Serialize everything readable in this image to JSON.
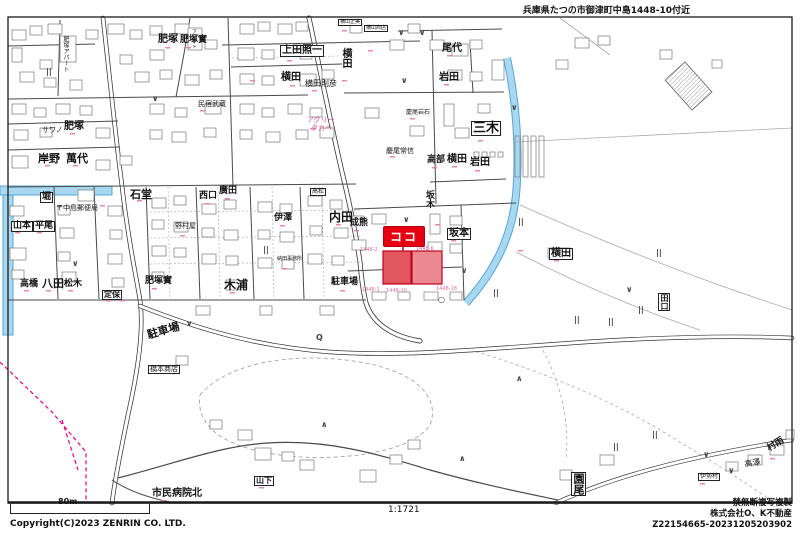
{
  "title": "兵庫県たつの市御津町中島1448-10付近",
  "footer": {
    "scale_bar_label": "80m",
    "copyright": "Copyright(C)2023 ZENRIN CO. LTD.",
    "scale_ratio": "1:1721",
    "notice": "禁無断複写複製",
    "company": "株式会社O、K不動産",
    "serial": "Z22154665-20231205203902"
  },
  "marker": {
    "label": "ココ",
    "color": "#e60012"
  },
  "colors": {
    "water_fill": "#a8d8f0",
    "water_stroke": "#58a6d6",
    "boundary_pink": "#e6007e",
    "parcel_pink": "#e06aa8",
    "highlight_fill": "#e2565e",
    "highlight_stroke": "#c00020",
    "road": "#4a4a4a"
  },
  "map": {
    "labels": [
      {
        "t": "肥塚",
        "x": 158,
        "y": 35,
        "c": "b10"
      },
      {
        "t": "肥塚實",
        "x": 180,
        "y": 36,
        "c": "b9"
      },
      {
        "t": "肥塚アパート",
        "x": 62,
        "y": 36,
        "c": "v sm6"
      },
      {
        "t": "アパート",
        "x": 191,
        "y": 29,
        "c": "v sm5"
      },
      {
        "t": "肥塚",
        "x": 64,
        "y": 122,
        "c": "b10"
      },
      {
        "t": "サワノ",
        "x": 42,
        "y": 127,
        "c": "sm7"
      },
      {
        "t": "岸野",
        "x": 38,
        "y": 153,
        "c": "b11"
      },
      {
        "t": "萬代",
        "x": 66,
        "y": 153,
        "c": "b11"
      },
      {
        "t": "堀",
        "x": 40,
        "y": 192,
        "c": "b9 box"
      },
      {
        "t": "〒中島郵便局",
        "x": 56,
        "y": 205,
        "c": "sm7"
      },
      {
        "t": "山本",
        "x": 11,
        "y": 221,
        "c": "b9 box"
      },
      {
        "t": "平尾",
        "x": 33,
        "y": 221,
        "c": "b9 box"
      },
      {
        "t": "八田",
        "x": 42,
        "y": 278,
        "c": "b11"
      },
      {
        "t": "高橋",
        "x": 20,
        "y": 280,
        "c": "b9"
      },
      {
        "t": "松木",
        "x": 64,
        "y": 280,
        "c": "b9"
      },
      {
        "t": "定保",
        "x": 102,
        "y": 290,
        "c": "b8 box"
      },
      {
        "t": "石堂",
        "x": 130,
        "y": 189,
        "c": "b11"
      },
      {
        "t": "肥塚實",
        "x": 145,
        "y": 277,
        "c": "b9"
      },
      {
        "t": "西口",
        "x": 199,
        "y": 192,
        "c": "b9"
      },
      {
        "t": "廣田",
        "x": 219,
        "y": 187,
        "c": "b9"
      },
      {
        "t": "伊澤",
        "x": 274,
        "y": 214,
        "c": "b9"
      },
      {
        "t": "内田",
        "x": 329,
        "y": 211,
        "c": "b12"
      },
      {
        "t": "木浦",
        "x": 224,
        "y": 279,
        "c": "b12"
      },
      {
        "t": "駐車場",
        "x": 146,
        "y": 330,
        "c": "b11",
        "r": -16
      },
      {
        "t": "駐車場",
        "x": 331,
        "y": 278,
        "c": "b9"
      },
      {
        "t": "橋本商店",
        "x": 148,
        "y": 365,
        "c": "sm7 box"
      },
      {
        "t": "市民病院北",
        "x": 152,
        "y": 489,
        "c": "b10"
      },
      {
        "t": "山下",
        "x": 254,
        "y": 476,
        "c": "b8 box"
      },
      {
        "t": "上田照一",
        "x": 280,
        "y": 45,
        "c": "b10 box"
      },
      {
        "t": "横田",
        "x": 340,
        "y": 48,
        "c": "b10 v"
      },
      {
        "t": "横田",
        "x": 281,
        "y": 73,
        "c": "b10"
      },
      {
        "t": "横田則彦",
        "x": 305,
        "y": 80,
        "c": "sm8"
      },
      {
        "t": "アグリー",
        "x": 307,
        "y": 117,
        "c": "sm7 pk"
      },
      {
        "t": "タカベ",
        "x": 311,
        "y": 125,
        "c": "sm7 pk"
      },
      {
        "t": "尾代",
        "x": 442,
        "y": 44,
        "c": "b10"
      },
      {
        "t": "岩田",
        "x": 439,
        "y": 73,
        "c": "b10"
      },
      {
        "t": "三木",
        "x": 471,
        "y": 121,
        "c": "b13 box"
      },
      {
        "t": "高部",
        "x": 427,
        "y": 156,
        "c": "b9"
      },
      {
        "t": "横田",
        "x": 447,
        "y": 155,
        "c": "b10"
      },
      {
        "t": "岩田",
        "x": 470,
        "y": 158,
        "c": "b10"
      },
      {
        "t": "慶尾岩石",
        "x": 406,
        "y": 110,
        "c": "sm6"
      },
      {
        "t": "慶尾常信",
        "x": 386,
        "y": 148,
        "c": "sm7"
      },
      {
        "t": "民宿武蔵",
        "x": 198,
        "y": 101,
        "c": "sm7"
      },
      {
        "t": "成熊",
        "x": 350,
        "y": 219,
        "c": "b9"
      },
      {
        "t": "坂木",
        "x": 424,
        "y": 190,
        "c": "b9 v"
      },
      {
        "t": "坂本",
        "x": 447,
        "y": 228,
        "c": "b10 box"
      },
      {
        "t": "横田",
        "x": 549,
        "y": 248,
        "c": "b10 box"
      },
      {
        "t": "田口",
        "x": 658,
        "y": 293,
        "c": "b8 box v"
      },
      {
        "t": "園尾",
        "x": 571,
        "y": 472,
        "c": "b11 box v"
      },
      {
        "t": "村雨",
        "x": 766,
        "y": 446,
        "c": "b9",
        "r": -32
      },
      {
        "t": "高澤",
        "x": 744,
        "y": 461,
        "c": "sm8",
        "r": -10
      },
      {
        "t": "横山正美",
        "x": 338,
        "y": 19,
        "c": "sm5 box"
      },
      {
        "t": "横山商店",
        "x": 364,
        "y": 25,
        "c": "sm5 box"
      },
      {
        "t": "野村屋",
        "x": 175,
        "y": 223,
        "c": "sm7"
      },
      {
        "t": "納田事務所",
        "x": 277,
        "y": 257,
        "c": "sm5"
      },
      {
        "t": "高松",
        "x": 310,
        "y": 188,
        "c": "sm6 box"
      },
      {
        "t": "伊勢村",
        "x": 698,
        "y": 473,
        "c": "sm6 box"
      }
    ],
    "symbols": [
      {
        "g": "∨",
        "x": 152,
        "y": 95
      },
      {
        "g": "∨",
        "x": 398,
        "y": 29
      },
      {
        "g": "∨",
        "x": 419,
        "y": 29
      },
      {
        "g": "∨",
        "x": 401,
        "y": 77
      },
      {
        "g": "∨",
        "x": 511,
        "y": 104
      },
      {
        "g": "∨",
        "x": 403,
        "y": 216
      },
      {
        "g": "∨",
        "x": 461,
        "y": 267
      },
      {
        "g": "∨",
        "x": 186,
        "y": 320
      },
      {
        "g": "∨",
        "x": 72,
        "y": 260
      },
      {
        "g": "∨",
        "x": 703,
        "y": 451
      },
      {
        "g": "∨",
        "x": 728,
        "y": 467
      },
      {
        "g": "∨",
        "x": 626,
        "y": 286
      },
      {
        "g": "||",
        "x": 46,
        "y": 68
      },
      {
        "g": "||",
        "x": 263,
        "y": 246
      },
      {
        "g": "||",
        "x": 493,
        "y": 289
      },
      {
        "g": "||",
        "x": 518,
        "y": 218
      },
      {
        "g": "||",
        "x": 656,
        "y": 249
      },
      {
        "g": "||",
        "x": 574,
        "y": 316
      },
      {
        "g": "||",
        "x": 608,
        "y": 318
      },
      {
        "g": "||",
        "x": 638,
        "y": 306
      },
      {
        "g": "||",
        "x": 613,
        "y": 443
      },
      {
        "g": "||",
        "x": 652,
        "y": 431
      },
      {
        "g": "∧",
        "x": 321,
        "y": 421
      },
      {
        "g": "∧",
        "x": 516,
        "y": 375
      },
      {
        "g": "∧",
        "x": 459,
        "y": 455
      },
      {
        "g": "○",
        "x": 438,
        "y": 296
      },
      {
        "g": "Q",
        "x": 316,
        "y": 334
      }
    ],
    "parcel_numbers": [
      {
        "t": "1448-2",
        "x": 360,
        "y": 248
      },
      {
        "t": "1448-6",
        "x": 416,
        "y": 247
      },
      {
        "t": "1448-1",
        "x": 362,
        "y": 288
      },
      {
        "t": "1448-10",
        "x": 386,
        "y": 289
      },
      {
        "t": "1448-18",
        "x": 436,
        "y": 287
      }
    ]
  }
}
